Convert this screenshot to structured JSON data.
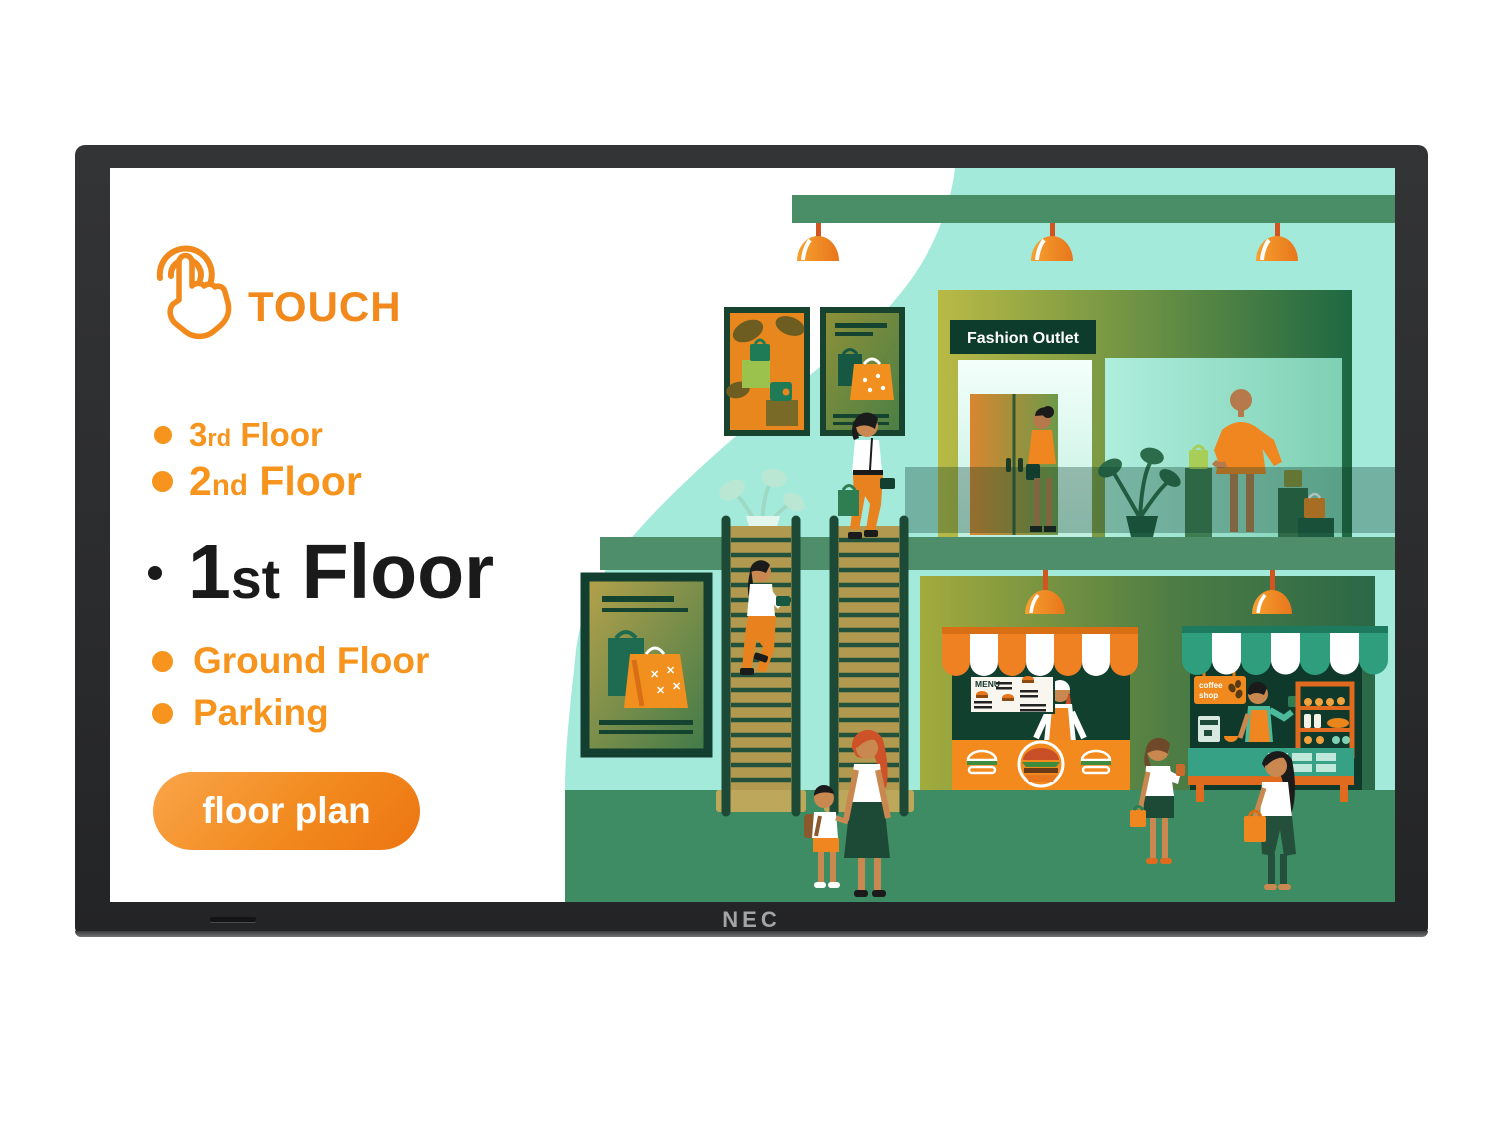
{
  "device": {
    "brand": "NEC"
  },
  "panel": {
    "touch_label": "TOUCH",
    "floors": [
      {
        "num": "3",
        "suffix": "rd",
        "name": "Floor"
      },
      {
        "num": "2",
        "suffix": "nd",
        "name": "Floor"
      },
      {
        "num": "1",
        "suffix": "st",
        "name": "Floor"
      },
      {
        "num": "",
        "suffix": "",
        "name": "Ground Floor"
      },
      {
        "num": "",
        "suffix": "",
        "name": "Parking"
      }
    ],
    "floor_plan_button": "floor plan"
  },
  "illustration": {
    "fashion_outlet_sign": "Fashion Outlet",
    "menu_board_title": "MENU",
    "coffee_sign": {
      "line1": "coffee",
      "line2": "shop"
    }
  },
  "icons": {
    "touch": "touch-hand-icon"
  },
  "colors": {
    "accent_orange": "#F7941D",
    "deep_orange": "#ED7512",
    "mint": "#A4EADB",
    "floor_green": "#3E8C63",
    "slab_green": "#4F8E6A",
    "dark_green": "#123F2F",
    "stair_gold": "#B19A4F",
    "active_text": "#1A1A1A",
    "bezel": "#2B2C2E"
  }
}
